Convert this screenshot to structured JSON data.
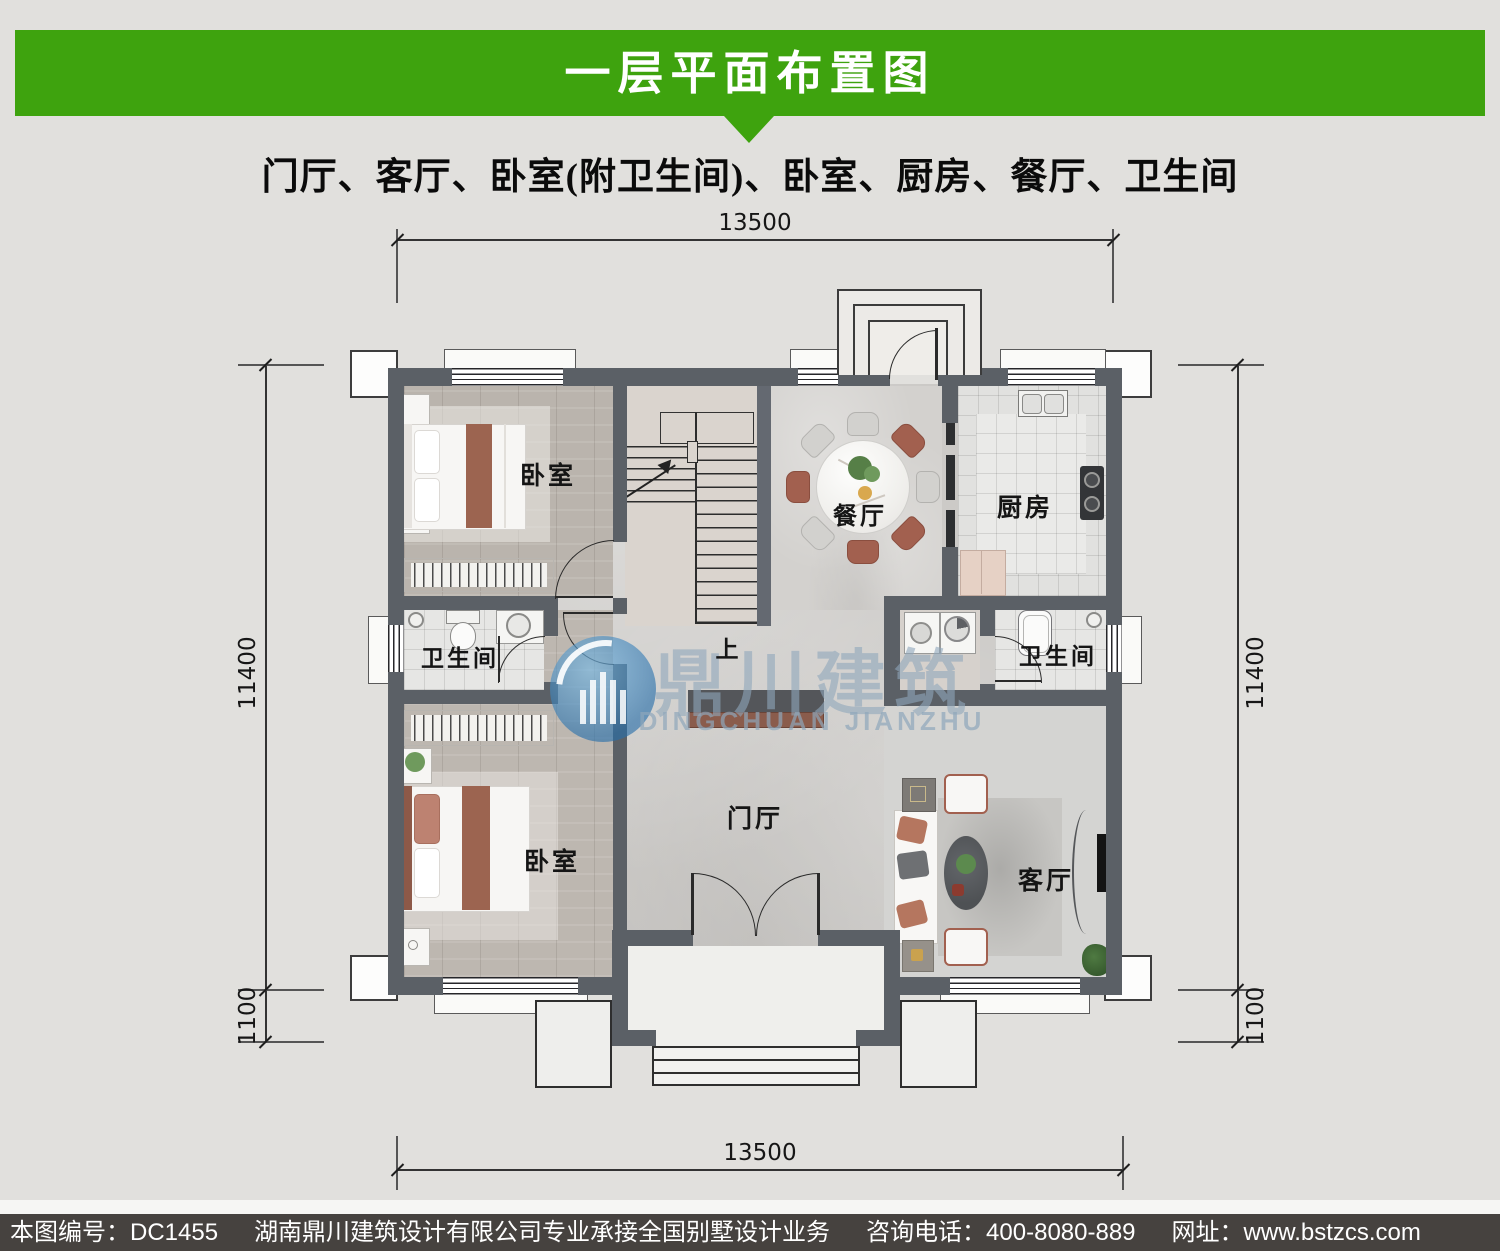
{
  "header": {
    "title": "一层平面布置图",
    "subtitle": "门厅、客厅、卧室(附卫生间)、卧室、厨房、餐厅、卫生间"
  },
  "colors": {
    "banner_green": "#3ea30e",
    "footer_bar": "#46423f",
    "wall_gray": "#5b6066",
    "watermark_blue": "#8fa6bb",
    "accent_rust": "#a2604f"
  },
  "dims": {
    "top": "13500",
    "bottom": "13500",
    "left_main": "11400",
    "left_small": "1100",
    "right_main": "11400",
    "right_small": "1100"
  },
  "rooms": {
    "bedroom_top": "卧室",
    "bedroom_bottom": "卧室",
    "bathroom_left": "卫生间",
    "bathroom_right": "卫生间",
    "kitchen": "厨房",
    "dining": "餐厅",
    "foyer": "门厅",
    "living": "客厅",
    "stair_up": "上"
  },
  "watermark": {
    "cn": "鼎川建筑",
    "en": "DINGCHUAN JIANZHU"
  },
  "footer": {
    "drawing_no": "本图编号：DC1455",
    "company": "湖南鼎川建筑设计有限公司专业承接全国别墅设计业务",
    "phone": "咨询电话：400-8080-889",
    "website": "网址：www.bstzcs.com"
  }
}
